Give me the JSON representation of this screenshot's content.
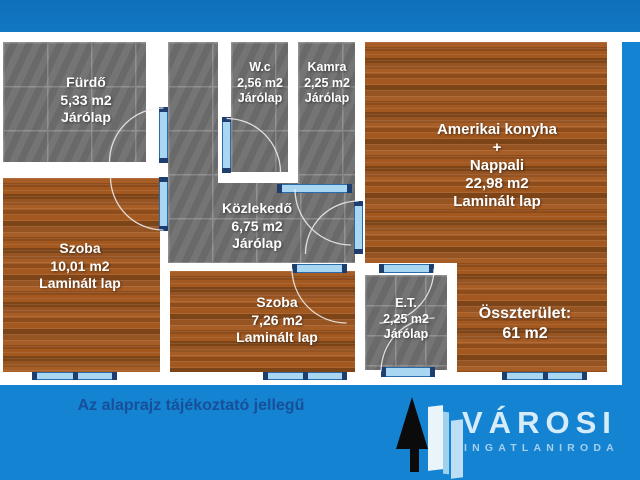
{
  "rooms": {
    "furdo": {
      "name": "Fürdő",
      "area": "5,33 m2",
      "floor": "Járólap"
    },
    "wc": {
      "name": "W.c",
      "area": "2,56 m2",
      "floor": "Járólap"
    },
    "kamra": {
      "name": "Kamra",
      "area": "2,25 m2",
      "floor": "Járólap"
    },
    "nappali": {
      "name": "Amerikai konyha",
      "plus": "+",
      "name2": "Nappali",
      "area": "22,98 m2",
      "floor": "Laminált lap"
    },
    "szoba1": {
      "name": "Szoba",
      "area": "10,01 m2",
      "floor": "Laminált lap"
    },
    "kozlekedo": {
      "name": "Közlekedő",
      "area": "6,75 m2",
      "floor": "Járólap"
    },
    "szoba2": {
      "name": "Szoba",
      "area": "7,26 m2",
      "floor": "Laminált lap"
    },
    "eloter": {
      "name": "E.T.",
      "area": "2,25 m2",
      "floor": "Járólap"
    }
  },
  "total": {
    "label": "Összterület:",
    "value": "61 m2"
  },
  "disclaimer": "Az alaprajz tájékoztató jellegű",
  "logo": {
    "brand": "VÁROSI",
    "subtitle": "INGATLANIRODA"
  },
  "colors": {
    "background": "#1483d2",
    "wall": "#ffffff",
    "tile_floor": "#6f6f6f",
    "wood_floor": "#9a5420",
    "door_fill": "#a9d7f1",
    "door_frame": "#1e3e70",
    "room_label": "#ffffff",
    "disclaimer_text": "#174f99",
    "brand_text": "#d6ecfb"
  }
}
